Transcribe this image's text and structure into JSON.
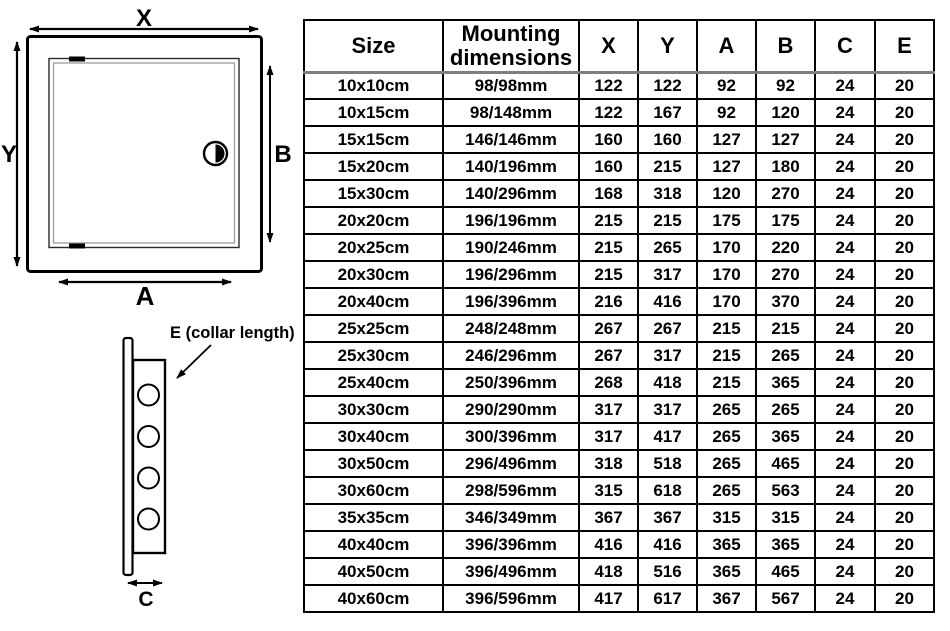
{
  "diagram": {
    "front_view": {
      "width_label": "X",
      "height_label": "Y",
      "opening_width_label": "A",
      "opening_height_label": "B"
    },
    "side_view": {
      "collar_label": "E (collar length)",
      "depth_label": "C"
    }
  },
  "table": {
    "columns": [
      "Size",
      "Mounting dimensions",
      "X",
      "Y",
      "A",
      "B",
      "C",
      "E"
    ],
    "rows": [
      [
        "10x10cm",
        "98/98mm",
        "122",
        "122",
        "92",
        "92",
        "24",
        "20"
      ],
      [
        "10x15cm",
        "98/148mm",
        "122",
        "167",
        "92",
        "120",
        "24",
        "20"
      ],
      [
        "15x15cm",
        "146/146mm",
        "160",
        "160",
        "127",
        "127",
        "24",
        "20"
      ],
      [
        "15x20cm",
        "140/196mm",
        "160",
        "215",
        "127",
        "180",
        "24",
        "20"
      ],
      [
        "15x30cm",
        "140/296mm",
        "168",
        "318",
        "120",
        "270",
        "24",
        "20"
      ],
      [
        "20x20cm",
        "196/196mm",
        "215",
        "215",
        "175",
        "175",
        "24",
        "20"
      ],
      [
        "20x25cm",
        "190/246mm",
        "215",
        "265",
        "170",
        "220",
        "24",
        "20"
      ],
      [
        "20x30cm",
        "196/296mm",
        "215",
        "317",
        "170",
        "270",
        "24",
        "20"
      ],
      [
        "20x40cm",
        "196/396mm",
        "216",
        "416",
        "170",
        "370",
        "24",
        "20"
      ],
      [
        "25x25cm",
        "248/248mm",
        "267",
        "267",
        "215",
        "215",
        "24",
        "20"
      ],
      [
        "25x30cm",
        "246/296mm",
        "267",
        "317",
        "215",
        "265",
        "24",
        "20"
      ],
      [
        "25x40cm",
        "250/396mm",
        "268",
        "418",
        "215",
        "365",
        "24",
        "20"
      ],
      [
        "30x30cm",
        "290/290mm",
        "317",
        "317",
        "265",
        "265",
        "24",
        "20"
      ],
      [
        "30x40cm",
        "300/396mm",
        "317",
        "417",
        "265",
        "365",
        "24",
        "20"
      ],
      [
        "30x50cm",
        "296/496mm",
        "318",
        "518",
        "265",
        "465",
        "24",
        "20"
      ],
      [
        "30x60cm",
        "298/596mm",
        "315",
        "618",
        "265",
        "563",
        "24",
        "20"
      ],
      [
        "35x35cm",
        "346/349mm",
        "367",
        "367",
        "315",
        "315",
        "24",
        "20"
      ],
      [
        "40x40cm",
        "396/396mm",
        "416",
        "416",
        "365",
        "365",
        "24",
        "20"
      ],
      [
        "40x50cm",
        "396/496mm",
        "418",
        "516",
        "365",
        "465",
        "24",
        "20"
      ],
      [
        "40x60cm",
        "396/596mm",
        "417",
        "617",
        "367",
        "567",
        "24",
        "20"
      ]
    ]
  }
}
